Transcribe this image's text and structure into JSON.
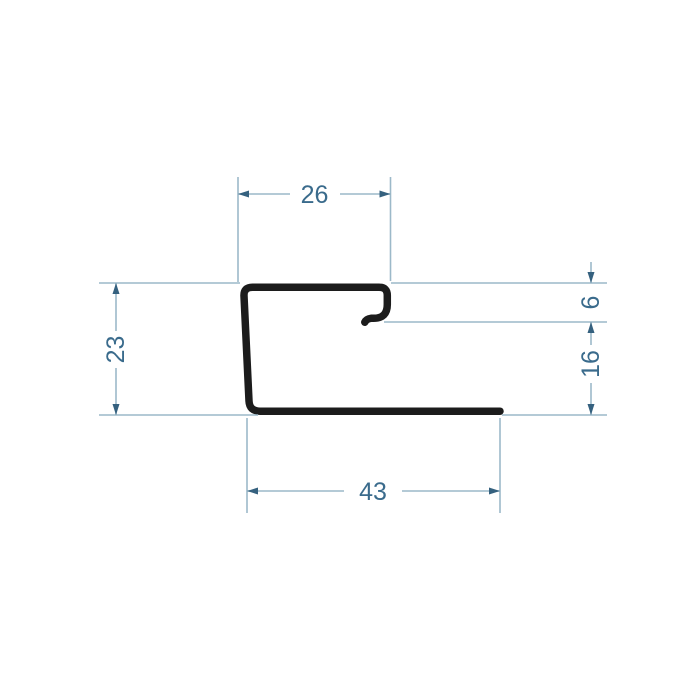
{
  "drawing": {
    "type": "technical-drawing",
    "subject": "j-trim-profile-cross-section",
    "dimensions": {
      "top_flange_width": {
        "label": "26"
      },
      "left_height": {
        "label": "23"
      },
      "hook_return_depth": {
        "label": "6"
      },
      "lower_right_height": {
        "label": "16"
      },
      "bottom_flange_width": {
        "label": "43"
      }
    },
    "colors": {
      "profile": "#1c1c1c",
      "dim_line": "#9cb9c9",
      "dim_accent": "#35617f",
      "text": "#3a6b8c",
      "background": "#ffffff"
    }
  }
}
